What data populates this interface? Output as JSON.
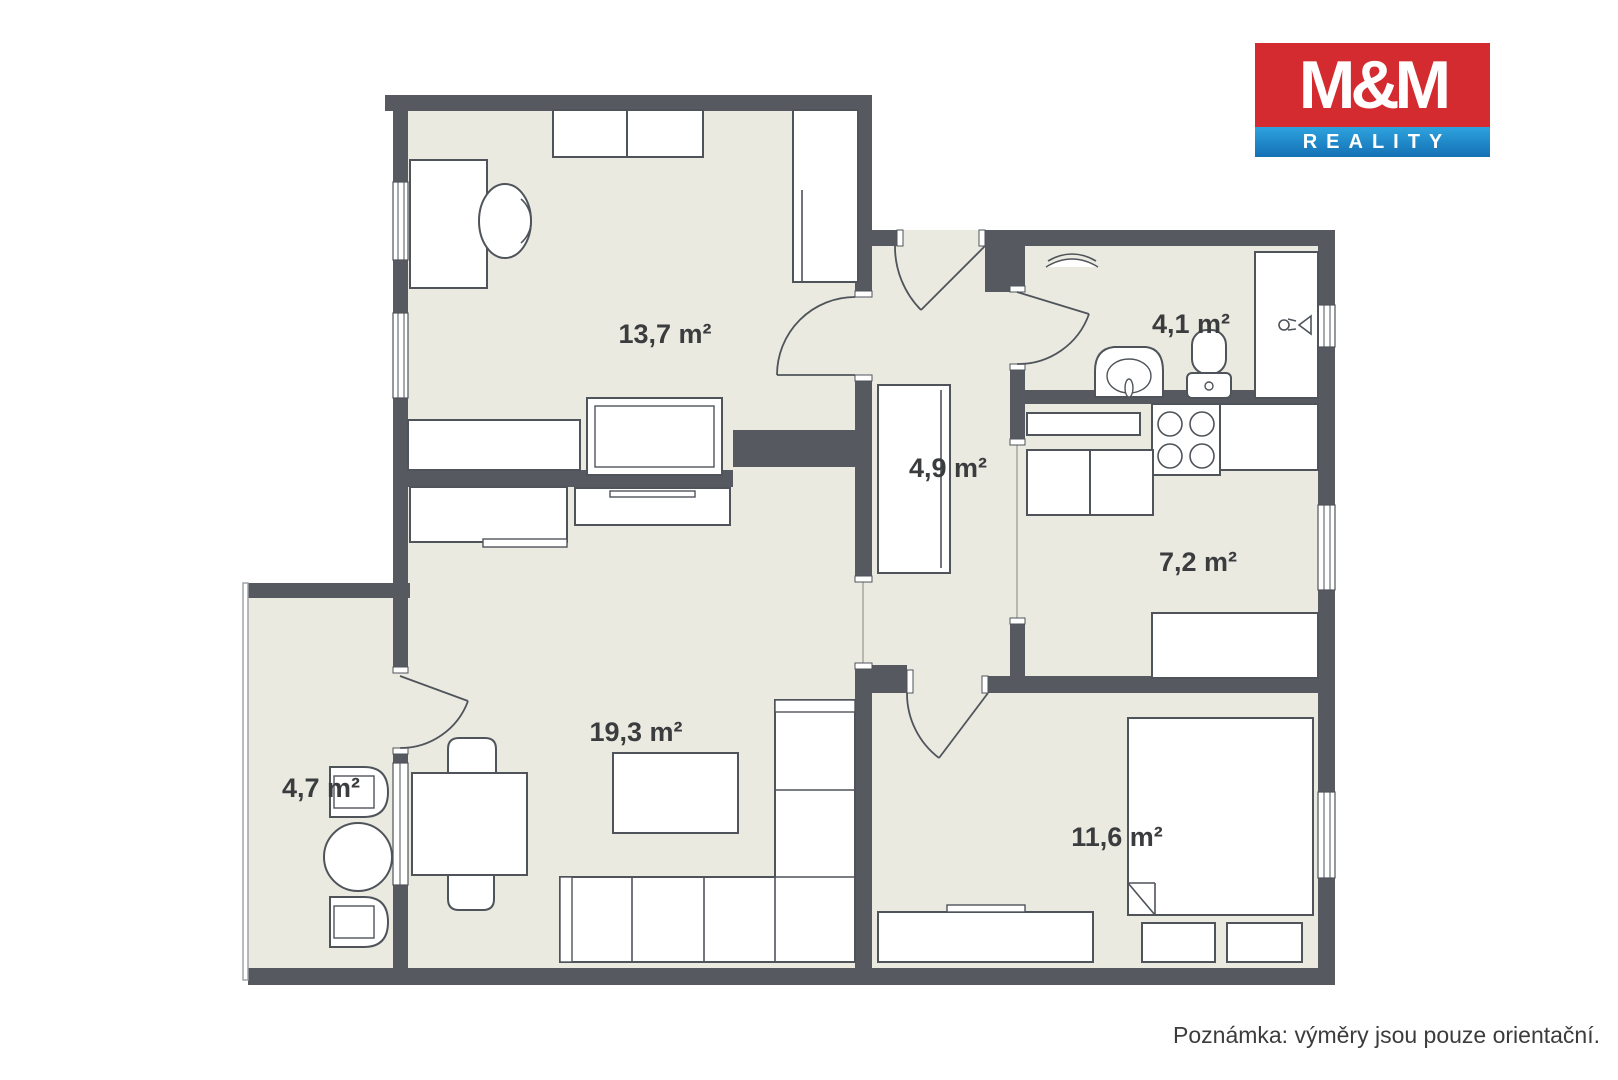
{
  "logo": {
    "line1": "M&M",
    "line2": "REALITY"
  },
  "note": {
    "text": "Poznámka: výměry jsou pouze orientační."
  },
  "plan": {
    "rooms": [
      {
        "name": "room-upper",
        "area": "13,7 m²"
      },
      {
        "name": "bathroom",
        "area": "4,1 m²"
      },
      {
        "name": "hallway",
        "area": "4,9 m²"
      },
      {
        "name": "kitchen",
        "area": "7,2 m²"
      },
      {
        "name": "living-room",
        "area": "19,3 m²"
      },
      {
        "name": "balcony",
        "area": "4,7 m²"
      },
      {
        "name": "bedroom",
        "area": "11,6 m²"
      }
    ]
  },
  "colors": {
    "wall": "#565a60",
    "floor": "#eaeae1",
    "line": "#4f545a",
    "brand_red": "#d42b31",
    "brand_blue_light": "#2ea3de",
    "brand_blue_dark": "#1470b4"
  }
}
